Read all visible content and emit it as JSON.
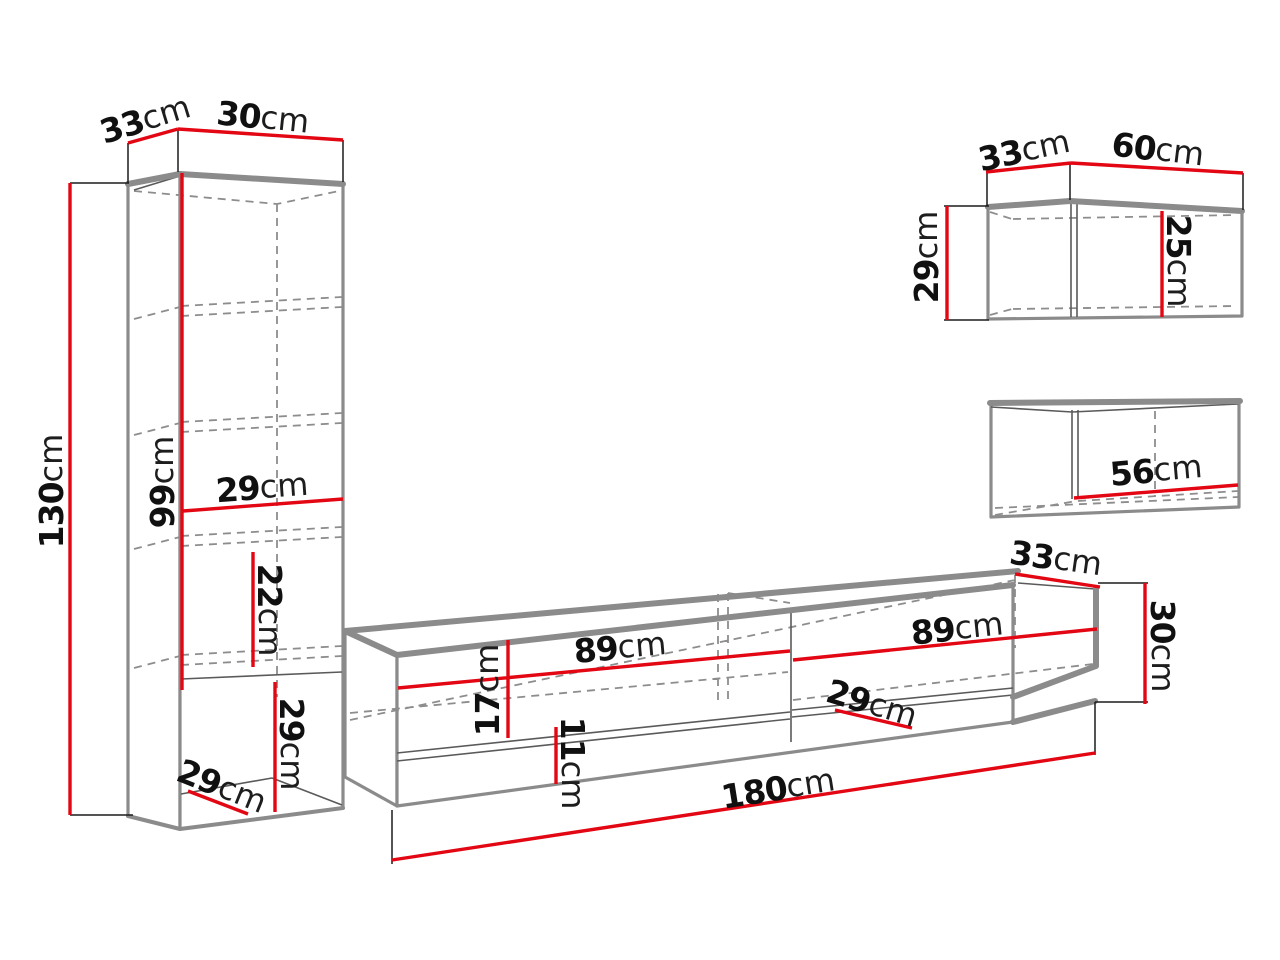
{
  "diagram": {
    "colors": {
      "dimension_line": "#e30613",
      "furniture_outline": "#8b8b8b",
      "hidden_line": "#8d8d8d",
      "text": "#101010",
      "background": "#ffffff"
    },
    "pieces": {
      "tall_cabinet": {
        "depth": {
          "value": "33",
          "unit": "cm"
        },
        "width": {
          "value": "30",
          "unit": "cm"
        },
        "height": {
          "value": "130",
          "unit": "cm"
        },
        "upper_section_height": {
          "value": "99",
          "unit": "cm"
        },
        "inner_width": {
          "value": "29",
          "unit": "cm"
        },
        "shelf_spacing": {
          "value": "22",
          "unit": "cm"
        },
        "open_section_height": {
          "value": "29",
          "unit": "cm"
        },
        "open_section_depth": {
          "value": "29",
          "unit": "cm"
        }
      },
      "tv_stand": {
        "left_section_width": {
          "value": "89",
          "unit": "cm"
        },
        "open_section_height": {
          "value": "17",
          "unit": "cm"
        },
        "drawer_front_height": {
          "value": "11",
          "unit": "cm"
        },
        "right_section_width": {
          "value": "89",
          "unit": "cm"
        },
        "inner_depth": {
          "value": "29",
          "unit": "cm"
        },
        "length": {
          "value": "180",
          "unit": "cm"
        },
        "depth": {
          "value": "33",
          "unit": "cm"
        },
        "height": {
          "value": "30",
          "unit": "cm"
        }
      },
      "wall_cabinet_upper": {
        "depth": {
          "value": "33",
          "unit": "cm"
        },
        "width": {
          "value": "60",
          "unit": "cm"
        },
        "height": {
          "value": "29",
          "unit": "cm"
        },
        "inner_height": {
          "value": "25",
          "unit": "cm"
        }
      },
      "wall_cabinet_lower": {
        "inner_width": {
          "value": "56",
          "unit": "cm"
        }
      }
    }
  }
}
